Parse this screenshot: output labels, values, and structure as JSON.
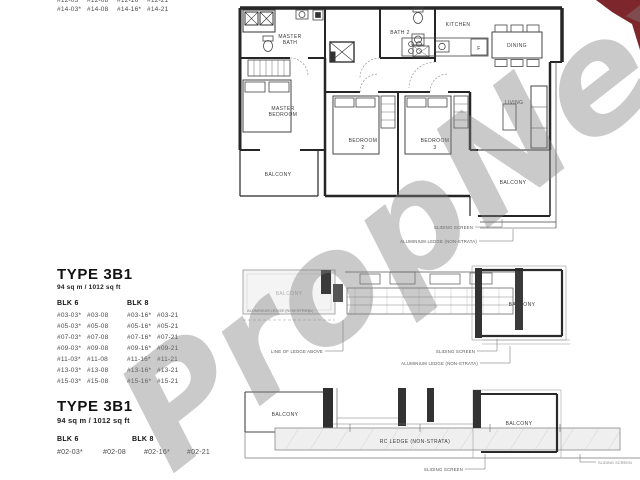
{
  "watermark": {
    "text": "PropNex",
    "color": "#808080",
    "corner_red": "#7d262c"
  },
  "top_unit_list": {
    "rows": [
      [
        "#12-03*",
        "#12-08",
        "#12-16*",
        "#12-21"
      ],
      [
        "#14-03*",
        "#14-08",
        "#14-16*",
        "#14-21"
      ]
    ]
  },
  "plan_top": {
    "master_bath_1": "MASTER",
    "master_bath_2": "BATH",
    "bath2": "BATH 2",
    "kitchen": "KITCHEN",
    "dining": "DINING",
    "living": "LIVING",
    "master_bedroom_1": "MASTER",
    "master_bedroom_2": "BEDROOM",
    "bedroom2_1": "BEDROOM",
    "bedroom2_2": "2",
    "bedroom3_1": "BEDROOM",
    "bedroom3_2": "3",
    "balcony_left": "BALCONY",
    "balcony_right": "BALCONY",
    "fridge": "F",
    "callout_sliding": "SLIDING SCREEN",
    "callout_alum": "ALUMINIUM LEDGE (NON-STRATA)"
  },
  "section_mid": {
    "title": "TYPE 3B1",
    "subtitle": "94 sq m / 1012 sq ft",
    "blk_left": "BLK 6",
    "blk_right": "BLK 8",
    "rows": [
      [
        "#03-03*",
        "#03-08",
        "#03-16*",
        "#03-21"
      ],
      [
        "#05-03*",
        "#05-08",
        "#05-16*",
        "#05-21"
      ],
      [
        "#07-03*",
        "#07-08",
        "#07-16*",
        "#07-21"
      ],
      [
        "#09-03*",
        "#09-08",
        "#09-16*",
        "#09-21"
      ],
      [
        "#11-03*",
        "#11-08",
        "#11-16*",
        "#11-21"
      ],
      [
        "#13-03*",
        "#13-08",
        "#13-16*",
        "#13-21"
      ],
      [
        "#15-03*",
        "#15-08",
        "#15-16*",
        "#15-21"
      ]
    ]
  },
  "plan_mid": {
    "balcony_left": "BALCONY",
    "balcony_right": "BALCONY",
    "callout_left_ledge": "ALUMINIUM LEDGE (NON-STRATA)",
    "callout_line_of_ledge": "LINE OF LEDGE ABOVE",
    "callout_sliding": "SLIDING SCREEN",
    "callout_alum": "ALUMINIUM LEDGE (NON-STRATA)"
  },
  "section_bottom": {
    "title": "TYPE 3B1",
    "subtitle": "94 sq m / 1012 sq ft",
    "blk_left": "BLK 6",
    "blk_right": "BLK 8",
    "rows": [
      [
        "#02-03*",
        "#02-08",
        "#02-16*",
        "#02-21"
      ]
    ]
  },
  "plan_bottom": {
    "balcony_left": "BALCONY",
    "balcony_right": "BALCONY",
    "rc_ledge": "RC LEDGE (NON-STRATA)",
    "callout_sliding": "SLIDING SCREEN",
    "callout_sliding2": "SLIDING SCREEN"
  }
}
